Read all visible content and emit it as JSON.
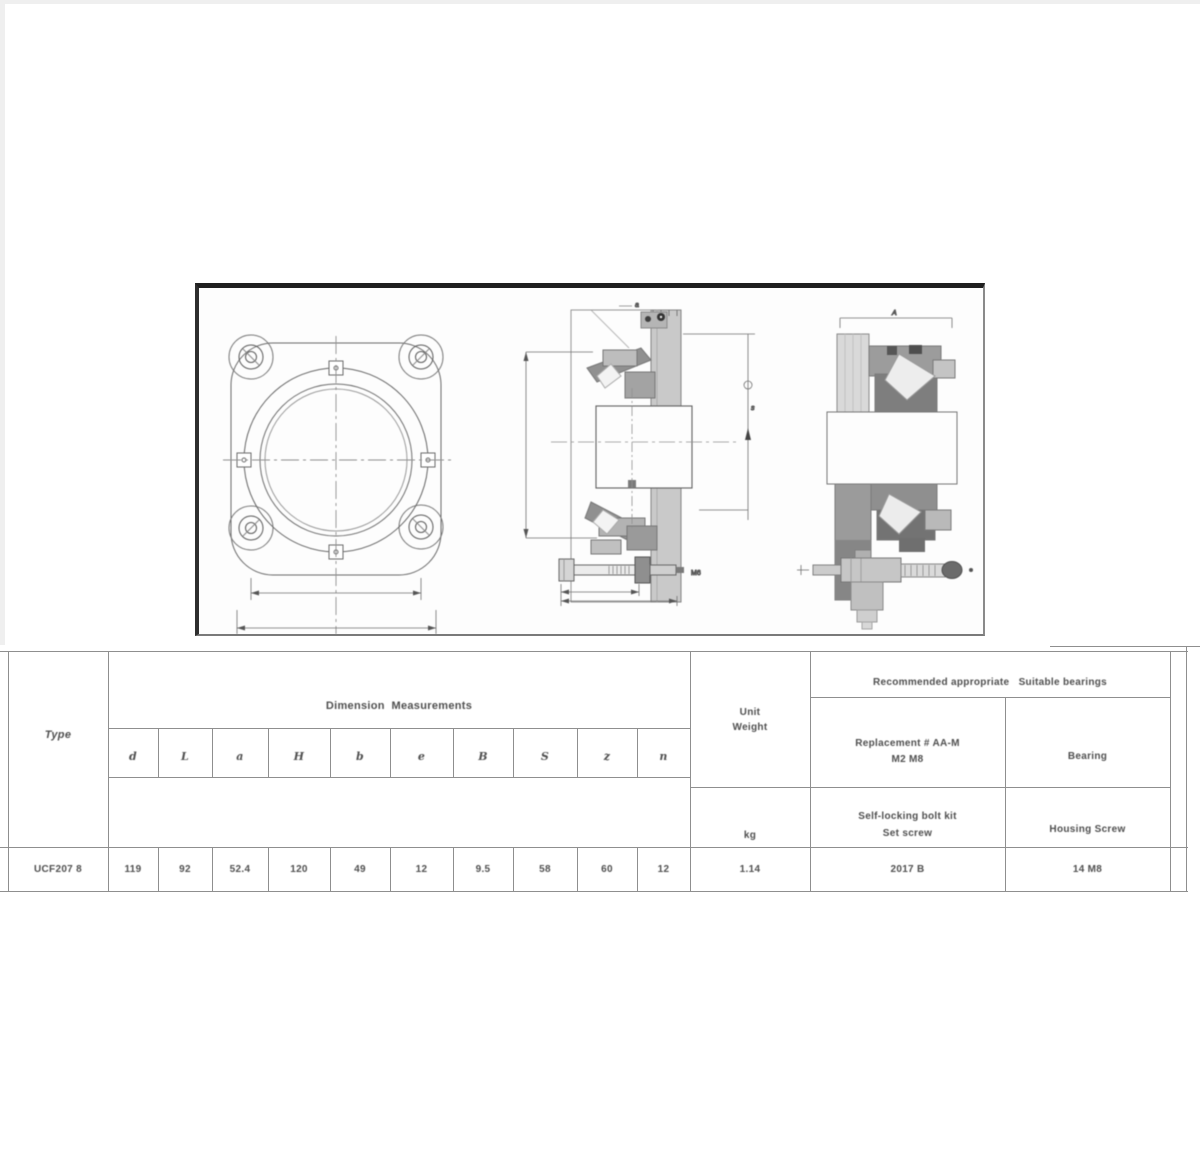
{
  "colors": {
    "panel_border": "#1f1f1f",
    "table_line": "#8f8f8f",
    "drawing_stroke": "#5a5a5a",
    "fill_dark": "#7e7e7e",
    "fill_mid": "#9c9c9c",
    "fill_light": "#d8d8d8"
  },
  "drawing": {
    "labels": {
      "section_top": "a",
      "section_right_upper": "s",
      "bolt_label": "M6",
      "side_top": "A"
    }
  },
  "table": {
    "type": {
      "header": "Type",
      "value": "UCF207 8"
    },
    "dimensions": {
      "group_header": "Dimension  Measurements",
      "columns": [
        "d",
        "L",
        "a",
        "H",
        "b",
        "e",
        "B",
        "S",
        "z",
        "n"
      ],
      "values": [
        "119",
        "92",
        "52.4",
        "120",
        "49",
        "12",
        "9.5",
        "58",
        "60",
        "12"
      ]
    },
    "weight": {
      "header_line1": "Unit",
      "header_line2": "Weight",
      "unit": "kg",
      "value": "1.14"
    },
    "matching": {
      "group_header": "Recommended appropriate   Suitable bearings",
      "bolt": {
        "header_line1": "Replacement # AA-M",
        "header_line2": "M2 M8",
        "label_line1": "Self-locking bolt kit",
        "label_line2": "Set screw",
        "value": "2017 B"
      },
      "bearing": {
        "header": "Bearing",
        "label": "Housing Screw",
        "value": "14 M8"
      }
    }
  }
}
